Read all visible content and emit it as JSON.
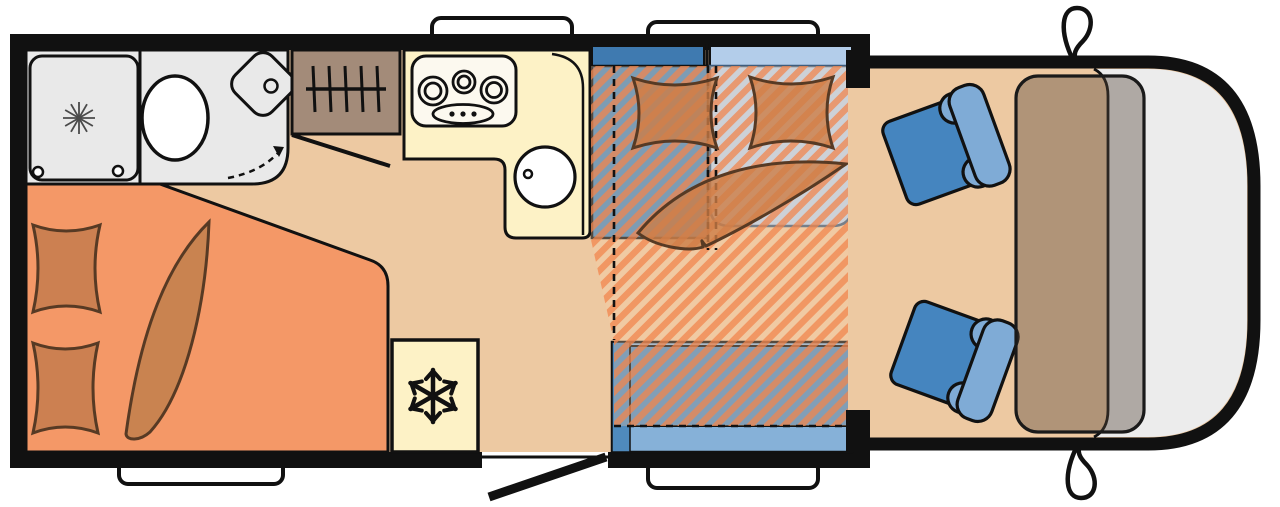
{
  "meta": {
    "type": "motorhome-floorplan"
  },
  "counts": {
    "windows": 4,
    "mirrors": 2,
    "cab_seats": 2,
    "bed_pillows": 2,
    "lounge_pillows": 2,
    "burners": 3
  },
  "icons": [
    "snowflake-icon",
    "shower-drain-icon",
    "clothes-rail-icon",
    "door-swing-arrow-icon",
    "burner-icon",
    "sink-icon",
    "mirror-icon"
  ],
  "colors": {
    "outline": "#111111",
    "floor": "#edc9a2",
    "bed": "#f49867",
    "pillow": "#cc8051",
    "blanket": "#c98350",
    "bedding_stroke": "#573a24",
    "bath": "#e9e9e9",
    "porcelain": "#ffffff",
    "wardrobe": "#a38b79",
    "kitchen": "#fdf2c6",
    "cooktop": "#fcf9ef",
    "sill_dark": "#3f7ab0",
    "sill_light": "#b3cdea",
    "bench_dark": "#4787ba",
    "seat_light": "#bad2ed",
    "seat_light_stroke": "#3f5d7d",
    "bench_mid": "#4f8abd",
    "bench_light": "#86b1d8",
    "stripe_a": "rgba(242,140,85,0.82)",
    "stripe_b": "rgba(250,205,165,0.30)",
    "lounge_bedding": "rgba(205,125,70,0.80)",
    "cab_seat": "#4585bf",
    "cab_seat_back": "#7fabd6",
    "dashboard": "rgba(84,70,58,0.40)",
    "windshield": "#ececec",
    "window_white": "#ffffff"
  }
}
